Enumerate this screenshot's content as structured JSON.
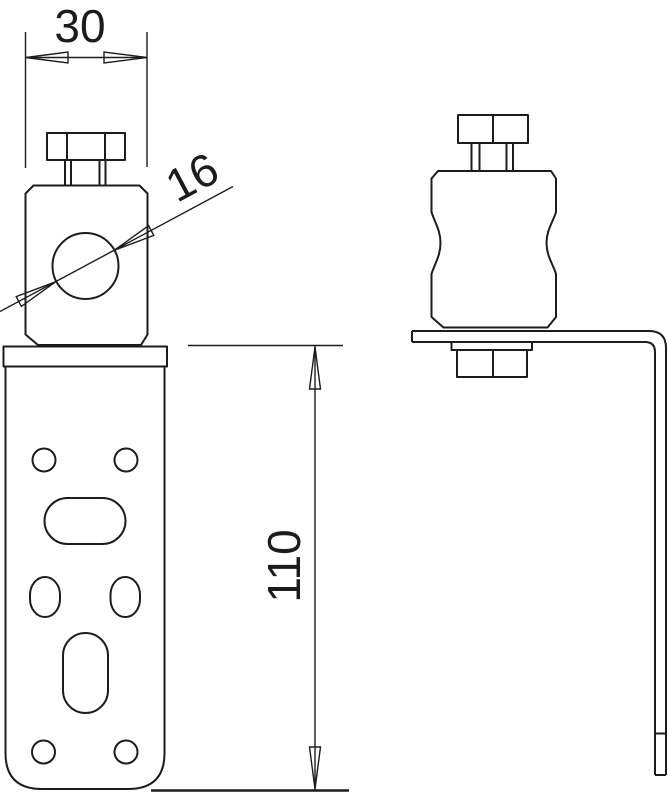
{
  "page": {
    "background_color": "#ffffff",
    "line_color": "#1c1c1c"
  },
  "drawing": {
    "kind": "technical-dimension-drawing",
    "dimensions": {
      "clamp_width": "30",
      "hole_diameter": "16",
      "bracket_height": "110"
    }
  }
}
